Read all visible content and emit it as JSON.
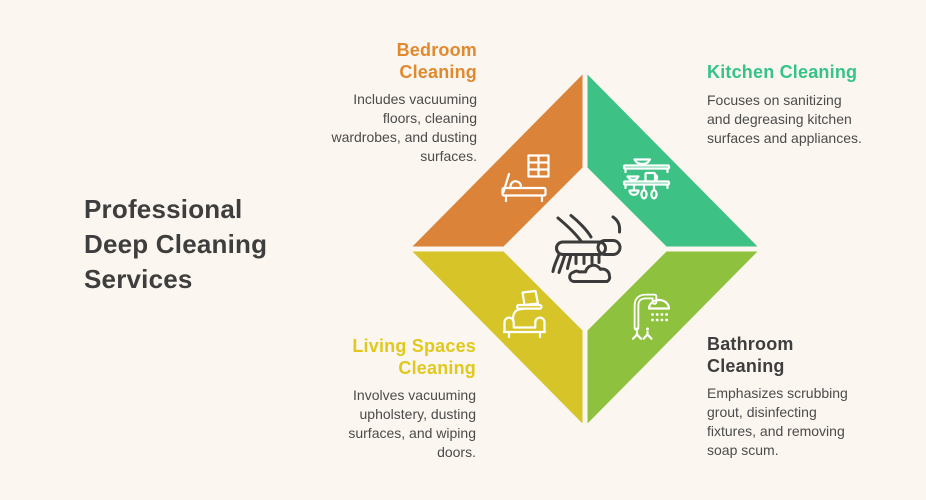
{
  "page": {
    "background_color": "#FBF6EF"
  },
  "title": {
    "text": "Professional Deep Cleaning Services",
    "lines": [
      "Professional",
      "Deep Cleaning",
      "Services"
    ],
    "color": "#3E3E3E"
  },
  "description_color": "#4B4B4B",
  "center_icon": "cleaning-brush-icon",
  "services": [
    {
      "id": "bedroom",
      "position": "top-left",
      "name": "Bedroom Cleaning",
      "description": "Includes vacuuming floors, cleaning wardrobes, and dusting surfaces.",
      "heading_color": "#E1892F",
      "quadrant_color": "#DB8338",
      "icon": "bed-window-icon"
    },
    {
      "id": "kitchen",
      "position": "top-right",
      "name": "Kitchen Cleaning",
      "description": "Focuses on sanitizing and degreasing kitchen surfaces and appliances.",
      "heading_color": "#35C388",
      "quadrant_color": "#3EC184",
      "icon": "kitchen-shelves-icon"
    },
    {
      "id": "living",
      "position": "bottom-left",
      "name": "Living Spaces Cleaning",
      "description": "Involves vacuuming upholstery, dusting surfaces, and wiping doors.",
      "heading_color": "#E2C81C",
      "quadrant_color": "#D7C428",
      "icon": "sofa-laptop-icon"
    },
    {
      "id": "bathroom",
      "position": "bottom-right",
      "name": "Bathroom Cleaning",
      "description": "Emphasizes scrubbing grout, disinfecting fixtures, and removing soap scum.",
      "heading_color": "#3E3E3E",
      "quadrant_color": "#8EC23E",
      "icon": "shower-icon"
    }
  ]
}
